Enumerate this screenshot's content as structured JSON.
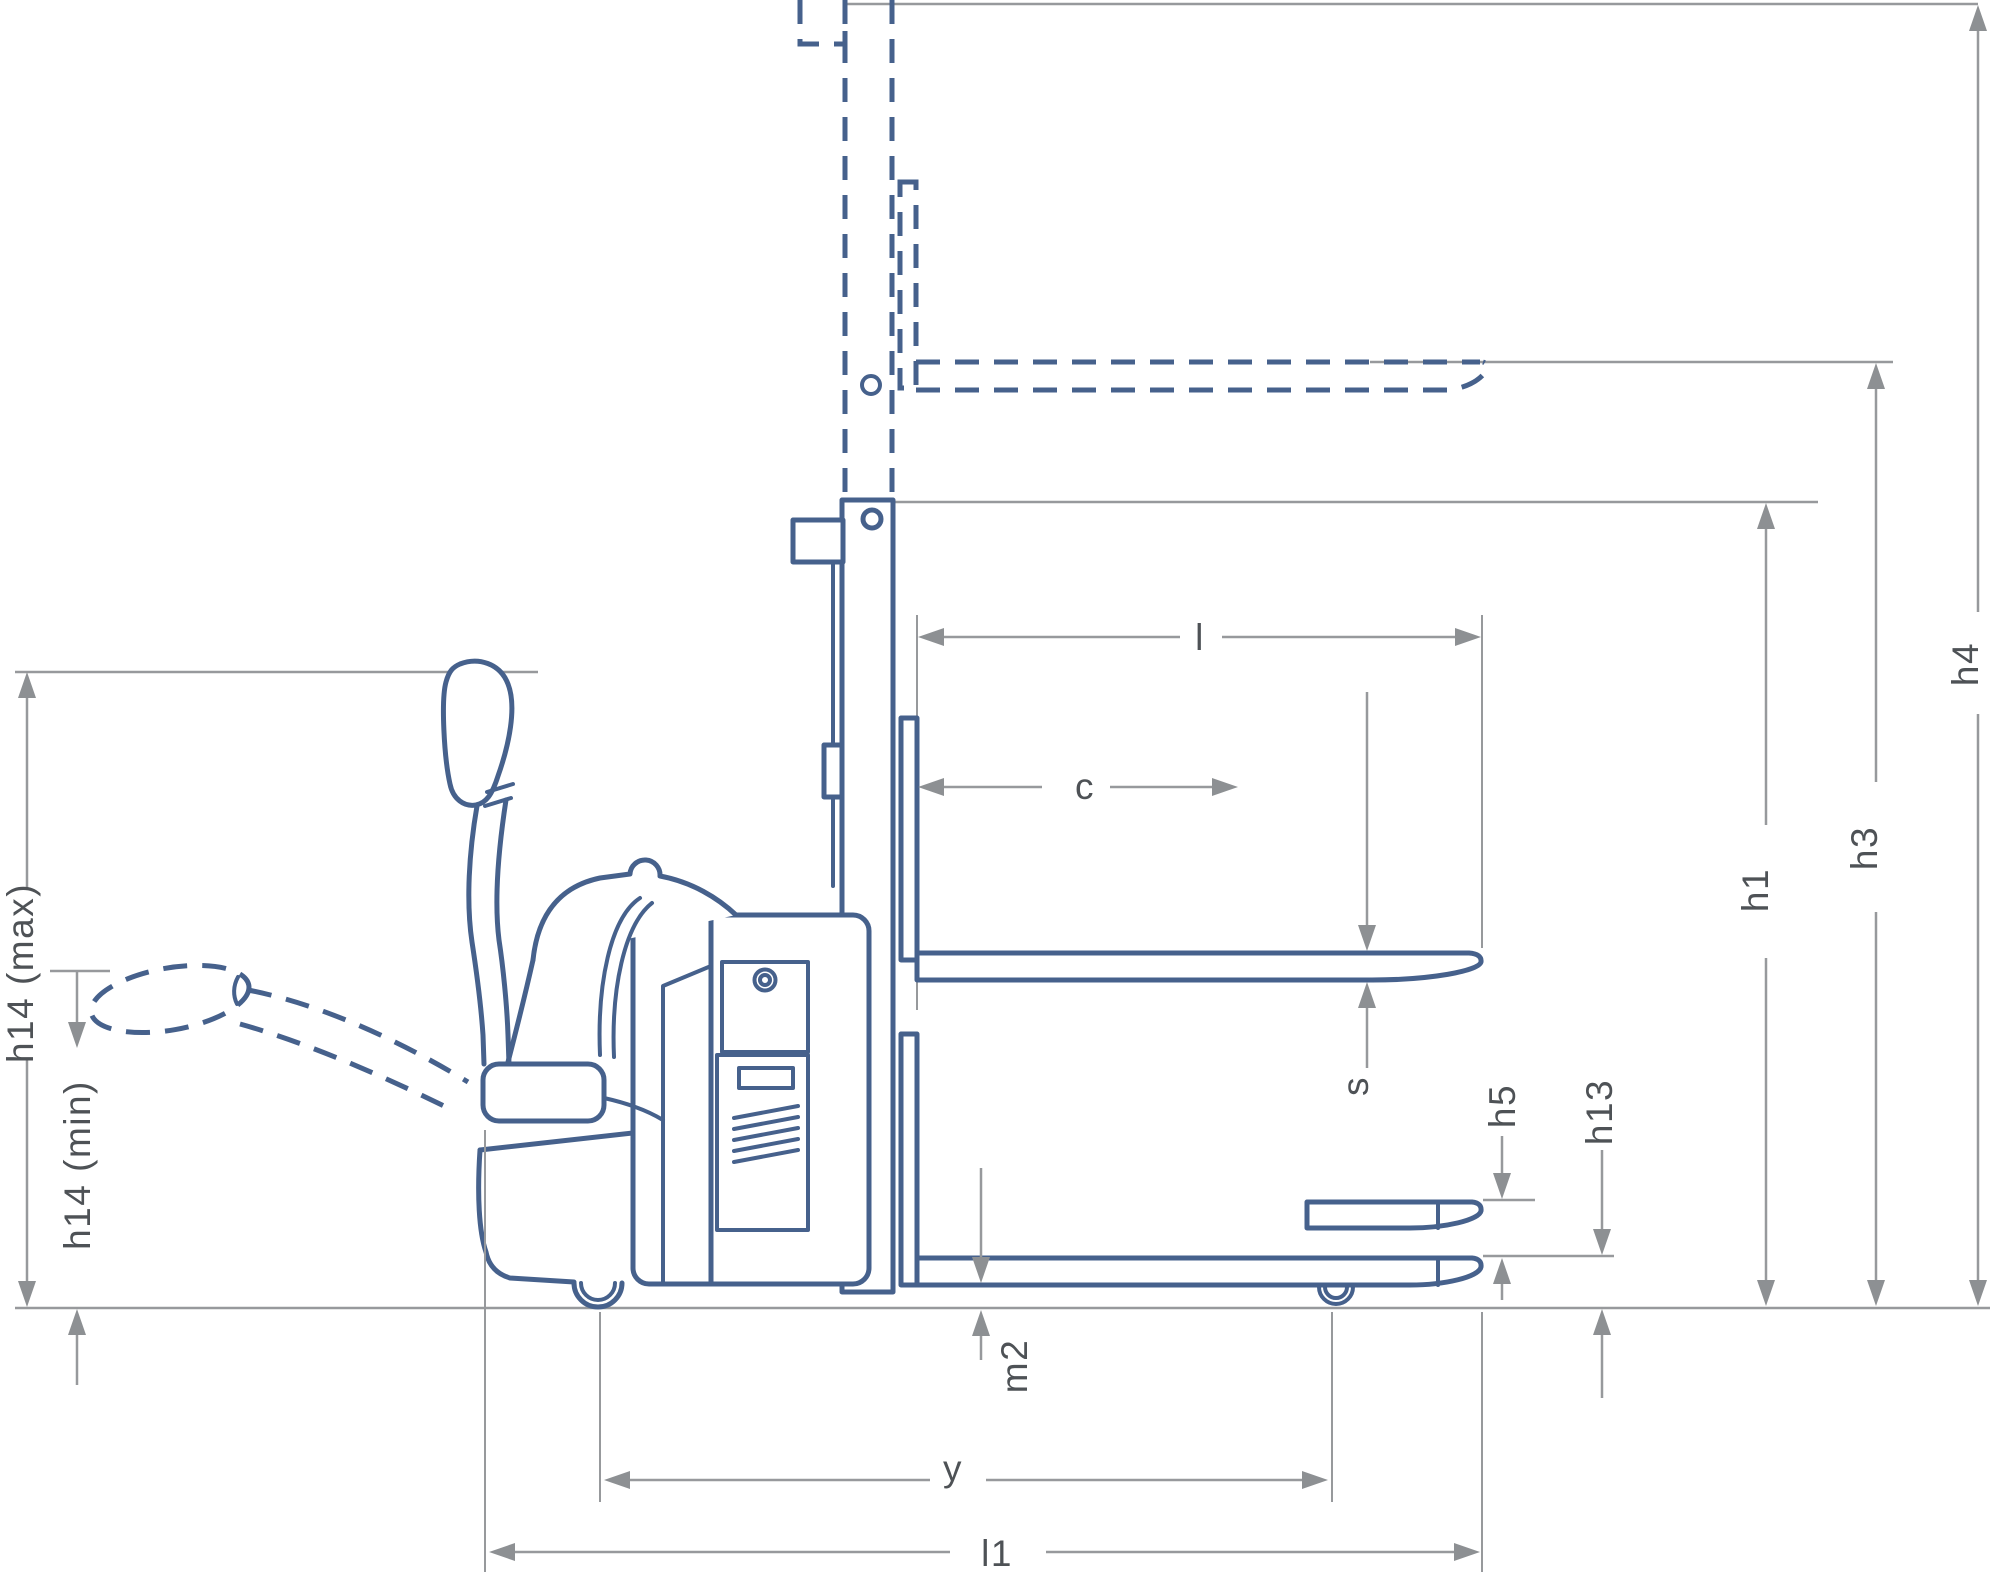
{
  "diagram": {
    "type": "side-view dimensional drawing of an electric pallet stacker truck",
    "labels": {
      "h14_max": "h14 (max)",
      "h14_min": "h14 (min)",
      "l": "l",
      "c": "c",
      "s": "s",
      "h5": "h5",
      "h13": "h13",
      "h1": "h1",
      "h3": "h3",
      "h4": "h4",
      "m2": "m2",
      "y": "y",
      "l1": "l1"
    },
    "colors": {
      "machine_outline_blue": "#46618c",
      "dimension_line_gray": "#97999c",
      "arrowhead_gray": "#8d9093",
      "label_text_gray": "#4e5256",
      "background": "#ffffff"
    },
    "line_styles": {
      "dashed_blue": "raised / alternate position of mast, fork carriage, forks and tiller arm",
      "solid_blue": "machine body, mast, forks, support arms",
      "solid_gray": "dimension and reference lines"
    }
  }
}
